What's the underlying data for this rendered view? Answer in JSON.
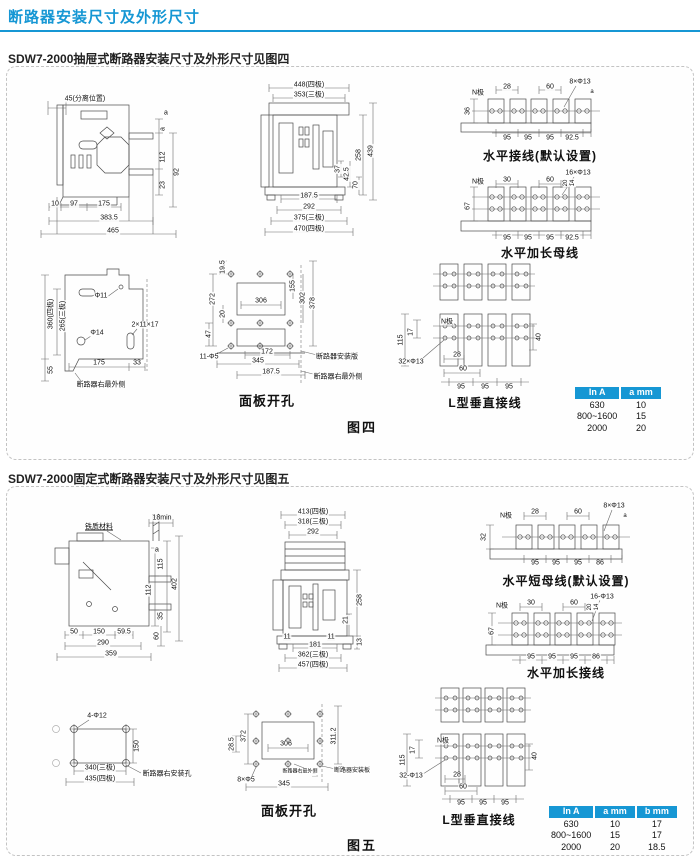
{
  "header": {
    "title": "断路器安装尺寸及外形尺寸"
  },
  "colors": {
    "accent": "#1697d4"
  },
  "sections": {
    "fig4": {
      "label": "SDW7-2000抽屉式断路器安装尺寸及外形尺寸见图四",
      "caption": "图四"
    },
    "fig5": {
      "label": "SDW7-2000固定式断路器安装尺寸及外形尺寸见图五",
      "caption": "图五"
    }
  },
  "tables": {
    "fig4": {
      "headers": [
        "In A",
        "a mm"
      ],
      "rows": [
        [
          "630",
          "10"
        ],
        [
          "800~1600",
          "15"
        ],
        [
          "2000",
          "20"
        ]
      ]
    },
    "fig5": {
      "headers": [
        "In A",
        "a mm",
        "b mm"
      ],
      "rows": [
        [
          "630",
          "10",
          "17"
        ],
        [
          "800~1600",
          "15",
          "17"
        ],
        [
          "2000",
          "20",
          "18.5"
        ]
      ]
    }
  },
  "figures": {
    "f4side": {
      "labels": [
        {
          "t": "45(分离位置)",
          "x": 64,
          "y": 22
        },
        {
          "t": "a",
          "x": 145,
          "y": 36
        },
        {
          "t": "a",
          "x": 142,
          "y": 52,
          "r": 1
        },
        {
          "t": "112",
          "x": 142,
          "y": 80,
          "r": 1
        },
        {
          "t": "23",
          "x": 142,
          "y": 108,
          "r": 1
        },
        {
          "t": "92",
          "x": 156,
          "y": 95,
          "r": 1
        },
        {
          "t": "10",
          "x": 34,
          "y": 127
        },
        {
          "t": "97",
          "x": 53,
          "y": 127
        },
        {
          "t": "175",
          "x": 83,
          "y": 127
        },
        {
          "t": "383.5",
          "x": 88,
          "y": 141
        },
        {
          "t": "465",
          "x": 92,
          "y": 154
        }
      ]
    },
    "f4front": {
      "labels": [
        {
          "t": "448(四极)",
          "x": 62,
          "y": 6
        },
        {
          "t": "353(三极)",
          "x": 62,
          "y": 16
        },
        {
          "t": "258",
          "x": 112,
          "y": 76,
          "r": 1
        },
        {
          "t": "439",
          "x": 124,
          "y": 72,
          "r": 1
        },
        {
          "t": "37",
          "x": 91,
          "y": 90,
          "r": 1
        },
        {
          "t": "42.5",
          "x": 100,
          "y": 95,
          "r": 1
        },
        {
          "t": "70",
          "x": 109,
          "y": 106,
          "r": 1
        },
        {
          "t": "187.5",
          "x": 62,
          "y": 117
        },
        {
          "t": "292",
          "x": 62,
          "y": 128
        },
        {
          "t": "375(三极)",
          "x": 62,
          "y": 139
        },
        {
          "t": "470(四极)",
          "x": 62,
          "y": 150
        }
      ]
    },
    "f4hdef": {
      "labels": [
        {
          "t": "N极",
          "x": 26,
          "y": 16
        },
        {
          "t": "28",
          "x": 55,
          "y": 10
        },
        {
          "t": "60",
          "x": 98,
          "y": 10
        },
        {
          "t": "8×Φ13",
          "x": 128,
          "y": 5
        },
        {
          "t": "a",
          "x": 140,
          "y": 15,
          "fs": 6
        },
        {
          "t": "36",
          "x": 16,
          "y": 34,
          "r": 1
        },
        {
          "t": "95",
          "x": 55,
          "y": 61
        },
        {
          "t": "95",
          "x": 76,
          "y": 61
        },
        {
          "t": "95",
          "x": 98,
          "y": 61
        },
        {
          "t": "92.5",
          "x": 120,
          "y": 61
        },
        {
          "t": "水平接线(默认设置)",
          "x": 88,
          "y": 79,
          "b": 1,
          "fs": 12
        }
      ]
    },
    "f4hext": {
      "labels": [
        {
          "t": "N极",
          "x": 26,
          "y": 13
        },
        {
          "t": "30",
          "x": 55,
          "y": 11
        },
        {
          "t": "60",
          "x": 98,
          "y": 11
        },
        {
          "t": "16×Φ13",
          "x": 126,
          "y": 4
        },
        {
          "t": "20",
          "x": 114,
          "y": 14,
          "r": 1,
          "fs": 6
        },
        {
          "t": "14",
          "x": 121,
          "y": 14,
          "r": 1,
          "fs": 6
        },
        {
          "t": "67",
          "x": 16,
          "y": 37,
          "r": 1
        },
        {
          "t": "95",
          "x": 55,
          "y": 69
        },
        {
          "t": "95",
          "x": 76,
          "y": 69
        },
        {
          "t": "95",
          "x": 98,
          "y": 69
        },
        {
          "t": "92.5",
          "x": 120,
          "y": 69
        },
        {
          "t": "水平加长母线",
          "x": 88,
          "y": 84,
          "b": 1,
          "fs": 12
        }
      ]
    },
    "f4lvert": {
      "labels": [
        {
          "t": "N极",
          "x": 54,
          "y": 60
        },
        {
          "t": "115",
          "x": 8,
          "y": 78,
          "r": 1
        },
        {
          "t": "17",
          "x": 18,
          "y": 70,
          "r": 1
        },
        {
          "t": "32×Φ13",
          "x": 18,
          "y": 100
        },
        {
          "t": "28",
          "x": 64,
          "y": 93
        },
        {
          "t": "60",
          "x": 70,
          "y": 107
        },
        {
          "t": "95",
          "x": 68,
          "y": 125
        },
        {
          "t": "95",
          "x": 92,
          "y": 125
        },
        {
          "t": "95",
          "x": 116,
          "y": 125
        },
        {
          "t": "40",
          "x": 146,
          "y": 75,
          "r": 1
        },
        {
          "t": "L型垂直接线",
          "x": 92,
          "y": 141,
          "b": 1,
          "fs": 12
        }
      ]
    },
    "f4mount": {
      "labels": [
        {
          "t": "Φ11",
          "x": 80,
          "y": 37
        },
        {
          "t": "2×11×17",
          "x": 124,
          "y": 66
        },
        {
          "t": "Φ14",
          "x": 76,
          "y": 74
        },
        {
          "t": "360(四极)",
          "x": 30,
          "y": 55,
          "r": 1
        },
        {
          "t": "265(三极)",
          "x": 42,
          "y": 57,
          "r": 1
        },
        {
          "t": "55",
          "x": 30,
          "y": 111,
          "r": 1
        },
        {
          "t": "175",
          "x": 78,
          "y": 104
        },
        {
          "t": "33",
          "x": 116,
          "y": 104
        },
        {
          "t": "断路器右最外侧",
          "x": 80,
          "y": 126,
          "fs": 7
        }
      ]
    },
    "f4panel": {
      "labels": [
        {
          "t": "19.5",
          "x": 26,
          "y": 14,
          "r": 1
        },
        {
          "t": "272",
          "x": 16,
          "y": 46,
          "r": 1
        },
        {
          "t": "20",
          "x": 26,
          "y": 61,
          "r": 1
        },
        {
          "t": "47",
          "x": 12,
          "y": 81,
          "r": 1
        },
        {
          "t": "306",
          "x": 64,
          "y": 48
        },
        {
          "t": "155",
          "x": 96,
          "y": 33,
          "r": 1
        },
        {
          "t": "302",
          "x": 106,
          "y": 45,
          "r": 1
        },
        {
          "t": "378",
          "x": 116,
          "y": 50,
          "r": 1
        },
        {
          "t": "11-Φ5",
          "x": 12,
          "y": 104
        },
        {
          "t": "172",
          "x": 70,
          "y": 99
        },
        {
          "t": "345",
          "x": 61,
          "y": 108
        },
        {
          "t": "187.5",
          "x": 74,
          "y": 119
        },
        {
          "t": "断路器安装版",
          "x": 140,
          "y": 104,
          "fs": 7
        },
        {
          "t": "断路器右最外侧",
          "x": 141,
          "y": 124,
          "fs": 7
        },
        {
          "t": "面板开孔",
          "x": 70,
          "y": 148,
          "b": 1,
          "fs": 13
        }
      ]
    },
    "f5side": {
      "labels": [
        {
          "t": "铁质材料",
          "x": 78,
          "y": 21,
          "fs": 7,
          "u": 1
        },
        {
          "t": "18min",
          "x": 141,
          "y": 12
        },
        {
          "t": "a",
          "x": 136,
          "y": 44
        },
        {
          "t": "115",
          "x": 140,
          "y": 58,
          "r": 1
        },
        {
          "t": "402",
          "x": 154,
          "y": 78,
          "r": 1
        },
        {
          "t": "112",
          "x": 128,
          "y": 84,
          "r": 1
        },
        {
          "t": "35",
          "x": 140,
          "y": 110,
          "r": 1
        },
        {
          "t": "60",
          "x": 136,
          "y": 130,
          "r": 1
        },
        {
          "t": "50",
          "x": 53,
          "y": 126
        },
        {
          "t": "150",
          "x": 78,
          "y": 126
        },
        {
          "t": "59.5",
          "x": 103,
          "y": 126
        },
        {
          "t": "290",
          "x": 82,
          "y": 137
        },
        {
          "t": "359",
          "x": 90,
          "y": 148
        }
      ]
    },
    "f5front": {
      "labels": [
        {
          "t": "413(四极)",
          "x": 56,
          "y": 6
        },
        {
          "t": "318(三极)",
          "x": 56,
          "y": 16
        },
        {
          "t": "292",
          "x": 56,
          "y": 26
        },
        {
          "t": "258",
          "x": 103,
          "y": 94,
          "r": 1
        },
        {
          "t": "21",
          "x": 89,
          "y": 114,
          "r": 1
        },
        {
          "t": "11",
          "x": 30,
          "y": 131
        },
        {
          "t": "11",
          "x": 74,
          "y": 131
        },
        {
          "t": "13",
          "x": 103,
          "y": 136,
          "r": 1
        },
        {
          "t": "181",
          "x": 58,
          "y": 139
        },
        {
          "t": "362(三极)",
          "x": 56,
          "y": 149
        },
        {
          "t": "457(四极)",
          "x": 56,
          "y": 159
        }
      ]
    },
    "f5hdef": {
      "labels": [
        {
          "t": "N极",
          "x": 44,
          "y": 15
        },
        {
          "t": "28",
          "x": 73,
          "y": 11
        },
        {
          "t": "60",
          "x": 116,
          "y": 11
        },
        {
          "t": "8×Φ13",
          "x": 152,
          "y": 5
        },
        {
          "t": "a",
          "x": 163,
          "y": 15,
          "fs": 6
        },
        {
          "t": "32",
          "x": 22,
          "y": 36,
          "r": 1
        },
        {
          "t": "95",
          "x": 73,
          "y": 62
        },
        {
          "t": "95",
          "x": 94,
          "y": 62
        },
        {
          "t": "95",
          "x": 116,
          "y": 62
        },
        {
          "t": "86",
          "x": 138,
          "y": 62
        },
        {
          "t": "水平短母线(默认设置)",
          "x": 104,
          "y": 80,
          "b": 1,
          "fs": 12
        }
      ]
    },
    "f5hext": {
      "labels": [
        {
          "t": "N极",
          "x": 40,
          "y": 13
        },
        {
          "t": "30",
          "x": 69,
          "y": 10
        },
        {
          "t": "60",
          "x": 112,
          "y": 10
        },
        {
          "t": "16-Φ13",
          "x": 140,
          "y": 4
        },
        {
          "t": "20",
          "x": 128,
          "y": 14,
          "r": 1,
          "fs": 6
        },
        {
          "t": "14",
          "x": 135,
          "y": 14,
          "r": 1,
          "fs": 6
        },
        {
          "t": "67",
          "x": 30,
          "y": 38,
          "r": 1
        },
        {
          "t": "95",
          "x": 69,
          "y": 64
        },
        {
          "t": "95",
          "x": 90,
          "y": 64
        },
        {
          "t": "95",
          "x": 112,
          "y": 64
        },
        {
          "t": "86",
          "x": 134,
          "y": 64
        },
        {
          "t": "水平加长接线",
          "x": 104,
          "y": 80,
          "b": 1,
          "fs": 12
        }
      ]
    },
    "f5lvert": {
      "labels": [
        {
          "t": "N极",
          "x": 50,
          "y": 55
        },
        {
          "t": "115",
          "x": 10,
          "y": 74,
          "r": 1
        },
        {
          "t": "17",
          "x": 20,
          "y": 64,
          "r": 1
        },
        {
          "t": "32-Φ13",
          "x": 18,
          "y": 90
        },
        {
          "t": "28",
          "x": 64,
          "y": 89
        },
        {
          "t": "60",
          "x": 70,
          "y": 101
        },
        {
          "t": "95",
          "x": 68,
          "y": 117
        },
        {
          "t": "95",
          "x": 90,
          "y": 117
        },
        {
          "t": "95",
          "x": 112,
          "y": 117
        },
        {
          "t": "40",
          "x": 142,
          "y": 70,
          "r": 1
        },
        {
          "t": "L型垂直接线",
          "x": 86,
          "y": 134,
          "b": 1,
          "fs": 12
        }
      ]
    },
    "f5mount": {
      "labels": [
        {
          "t": "4-Φ12",
          "x": 74,
          "y": 15
        },
        {
          "t": "150",
          "x": 114,
          "y": 45,
          "r": 1
        },
        {
          "t": "340(三极)",
          "x": 77,
          "y": 67
        },
        {
          "t": "435(四极)",
          "x": 77,
          "y": 78
        },
        {
          "t": "断路器右安装孔",
          "x": 144,
          "y": 73,
          "fs": 7
        }
      ]
    },
    "f5panel": {
      "labels": [
        {
          "t": "28.5",
          "x": 6,
          "y": 48,
          "r": 1
        },
        {
          "t": "372",
          "x": 18,
          "y": 40,
          "r": 1
        },
        {
          "t": "306",
          "x": 60,
          "y": 48
        },
        {
          "t": "311.2",
          "x": 108,
          "y": 40,
          "r": 1
        },
        {
          "t": "8×Φ5",
          "x": 20,
          "y": 84
        },
        {
          "t": "345",
          "x": 58,
          "y": 88
        },
        {
          "t": "2",
          "x": 88,
          "y": 77,
          "fs": 6
        },
        {
          "t": "断路器右最外侧",
          "x": 74,
          "y": 76,
          "fs": 5
        },
        {
          "t": "断路器安装板",
          "x": 126,
          "y": 75,
          "fs": 6
        },
        {
          "t": "面板开孔",
          "x": 63,
          "y": 115,
          "b": 1,
          "fs": 13
        }
      ]
    }
  }
}
